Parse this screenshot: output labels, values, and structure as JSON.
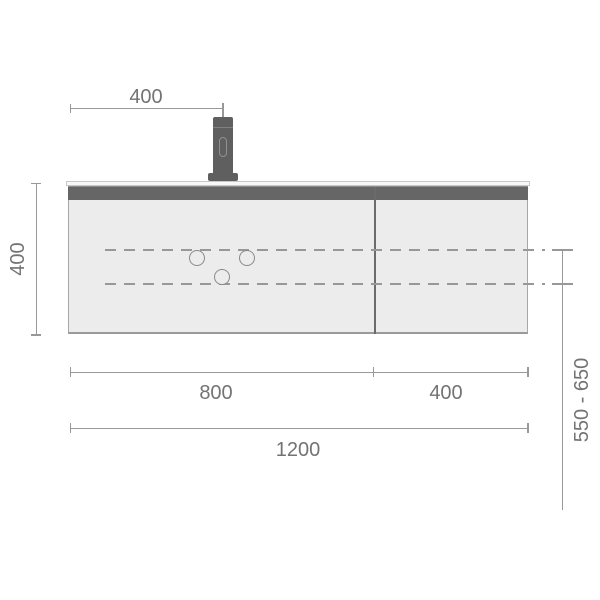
{
  "drawing": {
    "title": "Vanity cabinet front-elevation technical drawing",
    "type": "dimensioned line drawing"
  },
  "labels": {
    "faucet_offset": "400",
    "cabinet_height": "400",
    "left_section_width": "800",
    "right_section_width": "400",
    "total_width": "1200",
    "mounting_height_range": "550 - 650"
  },
  "colors": {
    "background": "#ffffff",
    "cabinet_body": "#ececec",
    "cabinet_outline": "#a8a8a8",
    "top_band": "#666666",
    "countertop": "#f8f8f8",
    "faucet": "#5f5f5f",
    "dimension_line": "#989898",
    "hole_outline": "#8a8a8a",
    "text": "#737373"
  }
}
